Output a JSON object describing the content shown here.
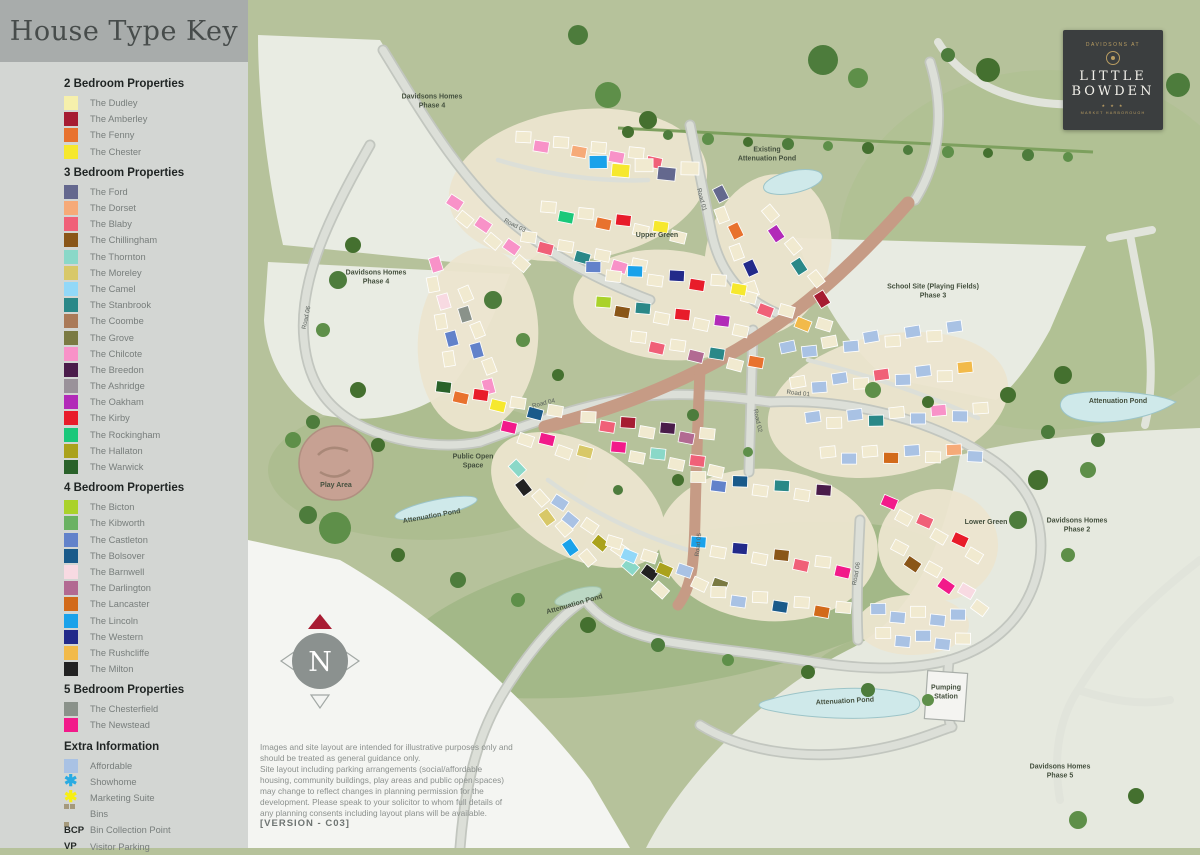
{
  "panel": {
    "title": "House Type Key",
    "sections": [
      {
        "heading": "2 Bedroom Properties",
        "items": [
          {
            "label": "The Dudley",
            "color": "#f6f0ac"
          },
          {
            "label": "The Amberley",
            "color": "#a61c32"
          },
          {
            "label": "The Fenny",
            "color": "#e8722e"
          },
          {
            "label": "The Chester",
            "color": "#f6e82e"
          }
        ]
      },
      {
        "heading": "3 Bedroom Properties",
        "items": [
          {
            "label": "The Ford",
            "color": "#64688e"
          },
          {
            "label": "The Dorset",
            "color": "#f6aa78"
          },
          {
            "label": "The Blaby",
            "color": "#f06078"
          },
          {
            "label": "The Chillingham",
            "color": "#8a5618"
          },
          {
            "label": "The Thornton",
            "color": "#8ad8c8"
          },
          {
            "label": "The Moreley",
            "color": "#d8c868"
          },
          {
            "label": "The Camel",
            "color": "#92d8f8"
          },
          {
            "label": "The Stanbrook",
            "color": "#2a8888"
          },
          {
            "label": "The Coombe",
            "color": "#aa7a58"
          },
          {
            "label": "The Grove",
            "color": "#7a7a42"
          },
          {
            "label": "The Chilcote",
            "color": "#f892c8"
          },
          {
            "label": "The Breedon",
            "color": "#4a1c4a"
          },
          {
            "label": "The Ashridge",
            "color": "#9a929a"
          },
          {
            "label": "The Oakham",
            "color": "#b22ab8"
          },
          {
            "label": "The Kirby",
            "color": "#e81c2a"
          },
          {
            "label": "The Rockingham",
            "color": "#1ac87a"
          },
          {
            "label": "The Hallaton",
            "color": "#aaa21c"
          },
          {
            "label": "The Warwick",
            "color": "#2a622a"
          }
        ]
      },
      {
        "heading": "4 Bedroom Properties",
        "items": [
          {
            "label": "The Bicton",
            "color": "#aad22a"
          },
          {
            "label": "The Kibworth",
            "color": "#6ab262"
          },
          {
            "label": "The Castleton",
            "color": "#6282ca"
          },
          {
            "label": "The Bolsover",
            "color": "#1a5a8a"
          },
          {
            "label": "The Barnwell",
            "color": "#f8dae2"
          },
          {
            "label": "The Darlington",
            "color": "#b26a92"
          },
          {
            "label": "The Lancaster",
            "color": "#d26a1a"
          },
          {
            "label": "The Lincoln",
            "color": "#1aa2ea"
          },
          {
            "label": "The Western",
            "color": "#222a8a"
          },
          {
            "label": "The Rushcliffe",
            "color": "#f2ba4a"
          },
          {
            "label": "The Milton",
            "color": "#222222"
          }
        ]
      },
      {
        "heading": "5 Bedroom Properties",
        "items": [
          {
            "label": "The Chesterfield",
            "color": "#8a928a"
          },
          {
            "label": "The Newstead",
            "color": "#f21a8a"
          }
        ]
      }
    ],
    "extra": {
      "heading": "Extra Information",
      "items": [
        {
          "label": "Affordable",
          "icon": "swatch",
          "color": "#a9c2e4"
        },
        {
          "label": "Showhome",
          "icon": "asterisk",
          "color": "#29abe2",
          "glyph": "✱"
        },
        {
          "label": "Marketing Suite",
          "icon": "asterisk",
          "color": "#f7ef13",
          "glyph": "✱"
        },
        {
          "label": "Bins",
          "icon": "bins",
          "color": "#a59a7c"
        },
        {
          "label": "Bin Collection Point",
          "icon": "text",
          "text": "BCP"
        },
        {
          "label": "Visitor Parking",
          "icon": "text",
          "text": "VP"
        }
      ]
    }
  },
  "logo": {
    "prefix": "DAVIDSONS AT",
    "name_line1": "LITTLE",
    "name_line2": "BOWDEN",
    "stars": "★ ★ ★",
    "location": "MARKET HARBOROUGH"
  },
  "compass": {
    "letter": "N"
  },
  "disclaimer": {
    "p1": "Images and site layout are intended for illustrative purposes only and should be treated as general guidance only.",
    "p2": "Site layout including parking arrangements (social/affordable housing, community buildings, play areas and public open spaces) may change to reflect changes in planning permission for the development. Please speak to your solicitor to whom full details of any planning consents including layout plans will be available.",
    "version": "[VERSION - C03]"
  },
  "map": {
    "labels": [
      {
        "t": "Davidsons Homes\nPhase 4",
        "x": 184,
        "y": 103
      },
      {
        "t": "Existing\nAttenuation Pond",
        "x": 519,
        "y": 156
      },
      {
        "t": "Road 01",
        "x": 452,
        "y": 200,
        "r": 75,
        "road": true
      },
      {
        "t": "Upper Green",
        "x": 409,
        "y": 237
      },
      {
        "t": "Road 03",
        "x": 266,
        "y": 227,
        "r": 27,
        "road": true
      },
      {
        "t": "Davidsons Homes\nPhase 4",
        "x": 128,
        "y": 279
      },
      {
        "t": "Road 06",
        "x": 60,
        "y": 318,
        "r": -78,
        "road": true
      },
      {
        "t": "School Site (Playing Fields)\nPhase 3",
        "x": 685,
        "y": 293
      },
      {
        "t": "Attenuation Pond",
        "x": 870,
        "y": 403
      },
      {
        "t": "Road 01",
        "x": 550,
        "y": 395,
        "r": 6,
        "road": true
      },
      {
        "t": "Road 02",
        "x": 508,
        "y": 421,
        "r": 78,
        "road": true
      },
      {
        "t": "Road 04",
        "x": 296,
        "y": 405,
        "r": -14,
        "road": true
      },
      {
        "t": "Public Open\nSpace",
        "x": 225,
        "y": 463
      },
      {
        "t": "Play Area",
        "x": 88,
        "y": 487
      },
      {
        "t": "Attenuation Pond",
        "x": 184,
        "y": 518,
        "r": -10
      },
      {
        "t": "Road 05",
        "x": 452,
        "y": 545,
        "r": -84,
        "road": true
      },
      {
        "t": "Road 06",
        "x": 610,
        "y": 574,
        "r": -80,
        "road": true
      },
      {
        "t": "Lower Green",
        "x": 738,
        "y": 524
      },
      {
        "t": "Davidsons Homes\nPhase 2",
        "x": 829,
        "y": 527
      },
      {
        "t": "Attenuation Pond",
        "x": 327,
        "y": 606,
        "r": -16
      },
      {
        "t": "Attenuation Pond",
        "x": 597,
        "y": 703,
        "r": -3
      },
      {
        "t": "Pumping\nStation",
        "x": 698,
        "y": 694
      },
      {
        "t": "Davidsons Homes\nPhase 5",
        "x": 812,
        "y": 773
      }
    ],
    "house_clusters": [
      {
        "x": 275,
        "y": 140,
        "angle": 8,
        "n": 8,
        "step": 19,
        "colors": [
          "#f1ead0",
          "#f892c8",
          "#f1ead0",
          "#f6aa78",
          "#f1ead0",
          "#f892c8",
          "#f1ead0",
          "#f06078"
        ]
      },
      {
        "x": 350,
        "y": 165,
        "angle": 4,
        "n": 5,
        "step": 23,
        "w": 18,
        "h": 13,
        "colors": [
          "#1aa2ea",
          "#f6e82e",
          "#f1ead0",
          "#64688e",
          "#f1ead0"
        ]
      },
      {
        "x": 205,
        "y": 205,
        "angle": 38,
        "n": 6,
        "step": 18,
        "colors": [
          "#f892c8",
          "#f1ead0",
          "#f892c8",
          "#f1ead0",
          "#f892c8",
          "#f1ead0"
        ]
      },
      {
        "x": 300,
        "y": 210,
        "angle": 10,
        "n": 8,
        "step": 19,
        "colors": [
          "#f1ead0",
          "#1ac87a",
          "#f1ead0",
          "#e8722e",
          "#e81c2a",
          "#f1ead0",
          "#f6e82e",
          "#f1ead0"
        ]
      },
      {
        "x": 280,
        "y": 240,
        "angle": 14,
        "n": 7,
        "step": 19,
        "colors": [
          "#f1ead0",
          "#f06078",
          "#f1ead0",
          "#2a8888",
          "#f1ead0",
          "#f892c8",
          "#f1ead0"
        ]
      },
      {
        "x": 470,
        "y": 195,
        "angle": 68,
        "n": 6,
        "step": 20,
        "colors": [
          "#64688e",
          "#f1ead0",
          "#e8722e",
          "#f1ead0",
          "#222a8a",
          "#f1ead0"
        ]
      },
      {
        "x": 520,
        "y": 215,
        "angle": 55,
        "n": 6,
        "step": 20,
        "colors": [
          "#f1ead0",
          "#b22ab8",
          "#f1ead0",
          "#2a8888",
          "#f1ead0",
          "#a61c32"
        ]
      },
      {
        "x": 500,
        "y": 300,
        "angle": 20,
        "n": 5,
        "step": 20,
        "colors": [
          "#f1ead0",
          "#f06078",
          "#f1ead0",
          "#f2ba4a",
          "#f1ead0"
        ]
      },
      {
        "x": 345,
        "y": 270,
        "angle": 6,
        "n": 8,
        "step": 21,
        "colors": [
          "#6282ca",
          "#f1ead0",
          "#1aa2ea",
          "#f1ead0",
          "#222a8a",
          "#e81c2a",
          "#f1ead0",
          "#f6e82e"
        ]
      },
      {
        "x": 355,
        "y": 305,
        "angle": 9,
        "n": 8,
        "step": 20,
        "colors": [
          "#aad22a",
          "#8a5618",
          "#2a8888",
          "#f1ead0",
          "#e81c2a",
          "#f1ead0",
          "#b22ab8",
          "#f1ead0"
        ]
      },
      {
        "x": 390,
        "y": 340,
        "angle": 12,
        "n": 7,
        "step": 20,
        "colors": [
          "#f1ead0",
          "#f06078",
          "#f1ead0",
          "#b26a92",
          "#2a8888",
          "#f1ead0",
          "#e8722e"
        ]
      },
      {
        "x": 185,
        "y": 265,
        "angle": 78,
        "n": 6,
        "step": 19,
        "colors": [
          "#f892c8",
          "#f1ead0",
          "#f8dae2",
          "#f1ead0",
          "#6282ca",
          "#f1ead0"
        ]
      },
      {
        "x": 215,
        "y": 295,
        "angle": 72,
        "n": 6,
        "step": 19,
        "colors": [
          "#f1ead0",
          "#8a928a",
          "#f1ead0",
          "#6282ca",
          "#f1ead0",
          "#f892c8"
        ]
      },
      {
        "x": 195,
        "y": 390,
        "angle": 12,
        "n": 7,
        "step": 19,
        "colors": [
          "#2a622a",
          "#e8722e",
          "#e81c2a",
          "#f6e82e",
          "#f1ead0",
          "#1a5a8a",
          "#f1ead0"
        ]
      },
      {
        "x": 260,
        "y": 430,
        "angle": 18,
        "n": 5,
        "step": 20,
        "colors": [
          "#f21a8a",
          "#f1ead0",
          "#f21a8a",
          "#f1ead0",
          "#d8c868"
        ]
      },
      {
        "x": 340,
        "y": 420,
        "angle": 8,
        "n": 7,
        "step": 20,
        "colors": [
          "#f1ead0",
          "#f06078",
          "#a61c32",
          "#f1ead0",
          "#4a1c4a",
          "#b26a92",
          "#f1ead0"
        ]
      },
      {
        "x": 370,
        "y": 450,
        "angle": 10,
        "n": 6,
        "step": 20,
        "colors": [
          "#f21a8a",
          "#f1ead0",
          "#8ad8c8",
          "#f1ead0",
          "#f06078",
          "#f1ead0"
        ]
      },
      {
        "x": 540,
        "y": 350,
        "angle": -7,
        "n": 9,
        "step": 21,
        "colors": [
          "#a9c2e4",
          "#a9c2e4",
          "#f1ead0",
          "#a9c2e4",
          "#a9c2e4",
          "#f1ead0",
          "#a9c2e4",
          "#f1ead0",
          "#a9c2e4"
        ]
      },
      {
        "x": 550,
        "y": 385,
        "angle": -5,
        "n": 9,
        "step": 21,
        "colors": [
          "#f1ead0",
          "#a9c2e4",
          "#a9c2e4",
          "#f1ead0",
          "#f06078",
          "#a9c2e4",
          "#a9c2e4",
          "#f1ead0",
          "#f2ba4a"
        ]
      },
      {
        "x": 565,
        "y": 420,
        "angle": -3,
        "n": 9,
        "step": 21,
        "colors": [
          "#a9c2e4",
          "#f1ead0",
          "#a9c2e4",
          "#2a8888",
          "#f1ead0",
          "#a9c2e4",
          "#f892c8",
          "#a9c2e4",
          "#f1ead0"
        ]
      },
      {
        "x": 580,
        "y": 455,
        "angle": -1,
        "n": 8,
        "step": 21,
        "colors": [
          "#f1ead0",
          "#a9c2e4",
          "#f1ead0",
          "#d26a1a",
          "#a9c2e4",
          "#f1ead0",
          "#f6aa78",
          "#a9c2e4"
        ]
      },
      {
        "x": 267,
        "y": 470,
        "angle": 52,
        "n": 7,
        "step": 19,
        "colors": [
          "#8ad8c8",
          "#222222",
          "#f1ead0",
          "#d8c868",
          "#f1ead0",
          "#1aa2ea",
          "#f1ead0"
        ]
      },
      {
        "x": 310,
        "y": 505,
        "angle": 38,
        "n": 8,
        "step": 19,
        "colors": [
          "#a9c2e4",
          "#a9c2e4",
          "#f1ead0",
          "#aaa21c",
          "#f1ead0",
          "#8ad8c8",
          "#222222",
          "#f1ead0"
        ]
      },
      {
        "x": 365,
        "y": 545,
        "angle": 22,
        "n": 7,
        "step": 19,
        "colors": [
          "#f1ead0",
          "#92d8f8",
          "#f1ead0",
          "#aaa21c",
          "#a9c2e4",
          "#f1ead0",
          "#7a7a42"
        ]
      },
      {
        "x": 450,
        "y": 480,
        "angle": 6,
        "n": 7,
        "step": 21,
        "colors": [
          "#f1ead0",
          "#6282ca",
          "#1a5a8a",
          "#f1ead0",
          "#2a8888",
          "#f1ead0",
          "#4a1c4a"
        ]
      },
      {
        "x": 450,
        "y": 545,
        "angle": 9,
        "n": 8,
        "step": 21,
        "colors": [
          "#1aa2ea",
          "#f1ead0",
          "#222a8a",
          "#f1ead0",
          "#8a5618",
          "#f06078",
          "#f1ead0",
          "#f21a8a"
        ]
      },
      {
        "x": 470,
        "y": 595,
        "angle": 7,
        "n": 7,
        "step": 21,
        "colors": [
          "#f1ead0",
          "#a9c2e4",
          "#f1ead0",
          "#1a5a8a",
          "#f1ead0",
          "#d26a1a",
          "#f1ead0"
        ]
      },
      {
        "x": 640,
        "y": 505,
        "angle": 28,
        "n": 6,
        "step": 20,
        "colors": [
          "#f21a8a",
          "#f1ead0",
          "#f06078",
          "#f1ead0",
          "#e81c2a",
          "#f1ead0"
        ]
      },
      {
        "x": 650,
        "y": 550,
        "angle": 33,
        "n": 6,
        "step": 20,
        "colors": [
          "#f1ead0",
          "#8a5618",
          "#f1ead0",
          "#f21a8a",
          "#f8dae2",
          "#f1ead0"
        ]
      },
      {
        "x": 630,
        "y": 612,
        "angle": 4,
        "n": 5,
        "step": 20,
        "colors": [
          "#a9c2e4",
          "#a9c2e4",
          "#f1ead0",
          "#a9c2e4",
          "#a9c2e4"
        ]
      },
      {
        "x": 635,
        "y": 636,
        "angle": 4,
        "n": 5,
        "step": 20,
        "colors": [
          "#f1ead0",
          "#a9c2e4",
          "#a9c2e4",
          "#a9c2e4",
          "#f1ead0"
        ]
      }
    ]
  }
}
